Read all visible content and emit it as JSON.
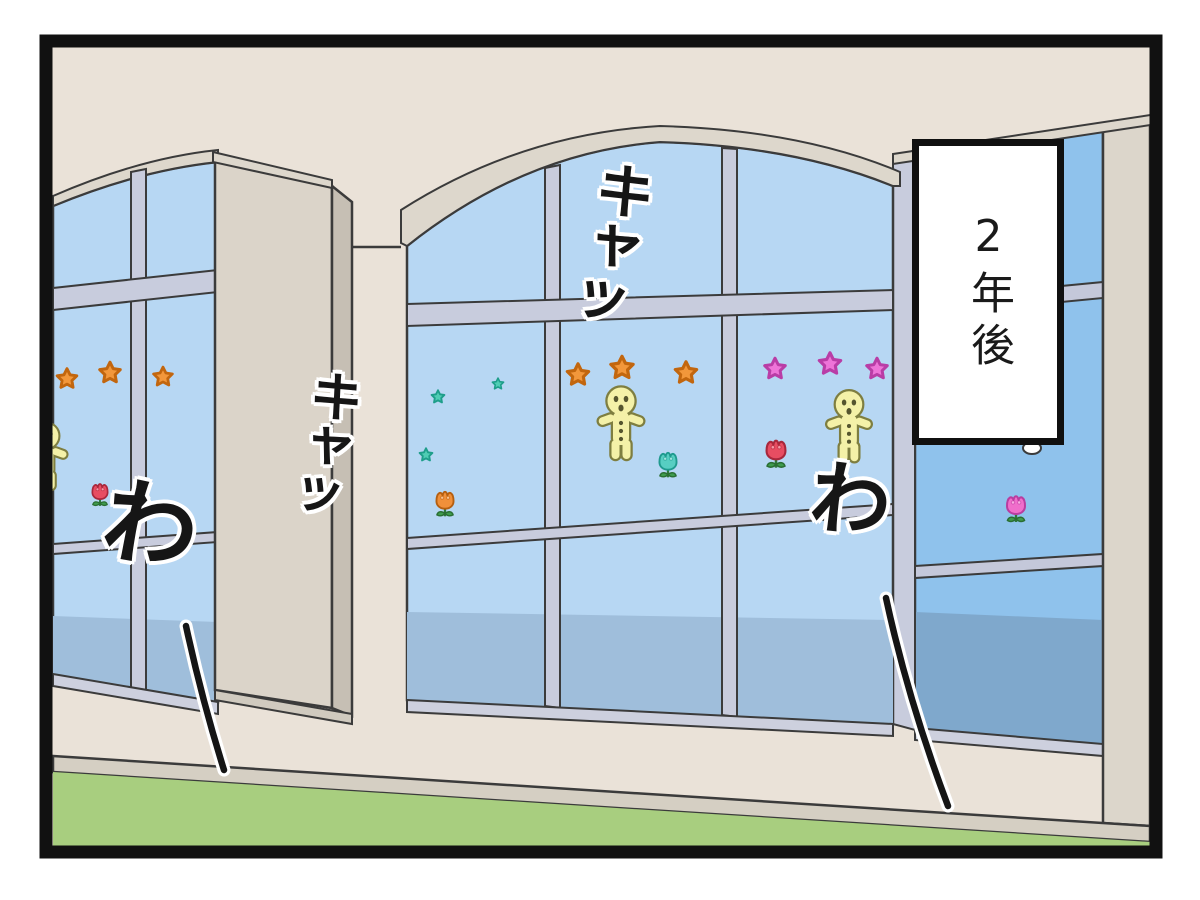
{
  "panel": {
    "caption": {
      "text": "2年後"
    },
    "sfx": [
      {
        "text": "キャッ"
      },
      {
        "text": "キャッ"
      },
      {
        "text": "わ"
      },
      {
        "text": "わ"
      }
    ],
    "colors": {
      "wall": "#EAE2D8",
      "pillar": "#DBD4C9",
      "pillar_side": "#C6BFB4",
      "trim": "#DDD7CC",
      "window_glass": "#B7D7F3",
      "window_glass_right_bay": "#8FC2EC",
      "glass_reflection": "#9FBEDB",
      "glass_reflection_right": "#7FA8CC",
      "mullion": "#C8CCDD",
      "ledge": "#D5CFC3",
      "grass": "#A8CE7F",
      "outline": "#3B3B3B",
      "panel_border": "#111111",
      "caption_background": "#FFFFFF",
      "sfx_text_color": "#161616"
    },
    "stickers": {
      "orange_flower_color": "#F2973B",
      "teal_flower_color": "#4FCDB4",
      "pink_flower_color": "#EE74D8",
      "gingerbread_color": "#F4F1A8",
      "tulip_red_color": "#E84D62",
      "tulip_orange_color": "#F0903A",
      "tulip_teal_color": "#57CEC2",
      "tulip_pink_color": "#F06ECB",
      "leaf_color": "#3E9C4D",
      "counts": {
        "orange_flowers": 6,
        "teal_flowers": 3,
        "pink_flowers": 3,
        "gingerbread_men": 3,
        "tulips": 5
      }
    }
  }
}
